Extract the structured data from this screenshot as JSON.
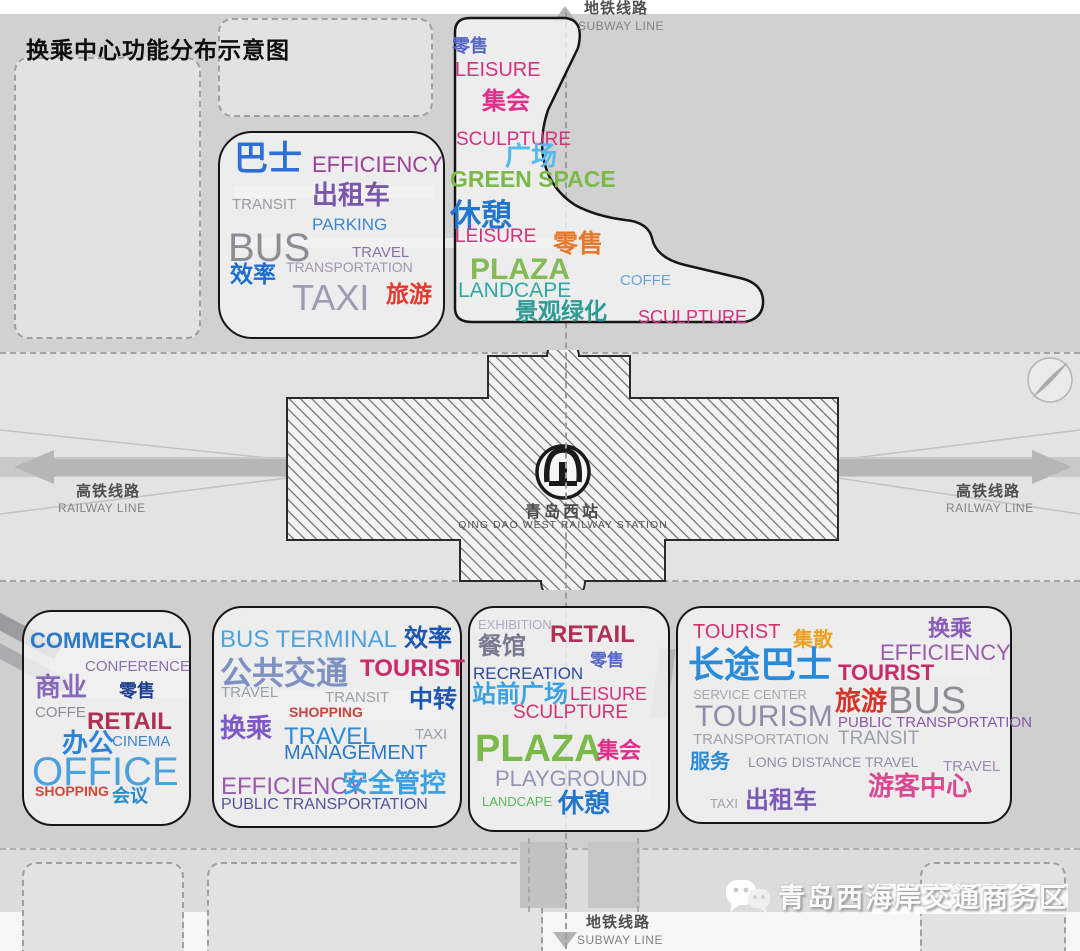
{
  "title": "换乘中心功能分布示意图",
  "axes": {
    "subway_top": {
      "cn": "地铁线路",
      "en": "SUBWAY LINE"
    },
    "subway_bottom": {
      "cn": "地铁线路",
      "en": "SUBWAY LINE"
    },
    "railway_left": {
      "cn": "高铁线路",
      "en": "RAILWAY LINE"
    },
    "railway_right": {
      "cn": "高铁线路",
      "en": "RAILWAY LINE"
    }
  },
  "station": {
    "cn": "青岛西站",
    "en": "QING DAO WEST RAILWAY STATION"
  },
  "watermark": "青岛西海岸交通商务区",
  "clouds": [
    {
      "id": "transit-hub-nw",
      "label": "bus / taxi transit zone",
      "words": [
        {
          "t": "巴士",
          "c": "#2e6fd6",
          "s": 34,
          "x": 14,
          "y": 9,
          "b": true
        },
        {
          "t": "EFFICIENCY",
          "c": "#9c3f98",
          "s": 22,
          "x": 92,
          "y": 21
        },
        {
          "t": "出租车",
          "c": "#7b57ab",
          "s": 26,
          "x": 92,
          "y": 49,
          "b": true
        },
        {
          "t": "TRANSIT",
          "c": "#9b9ba3",
          "s": 15,
          "x": 12,
          "y": 64
        },
        {
          "t": "PARKING",
          "c": "#3f86ce",
          "s": 17,
          "x": 92,
          "y": 83
        },
        {
          "t": "BUS",
          "c": "#8d8d97",
          "s": 40,
          "x": 8,
          "y": 95
        },
        {
          "t": "TRAVEL",
          "c": "#8f70ae",
          "s": 15,
          "x": 132,
          "y": 112
        },
        {
          "t": "TRANSPORTATION",
          "c": "#a095b2",
          "s": 14,
          "x": 66,
          "y": 127
        },
        {
          "t": "效率",
          "c": "#1e6ed2",
          "s": 23,
          "x": 10,
          "y": 130,
          "b": true
        },
        {
          "t": "TAXI",
          "c": "#a09ab3",
          "s": 36,
          "x": 72,
          "y": 147
        },
        {
          "t": "旅游",
          "c": "#e4392b",
          "s": 23,
          "x": 166,
          "y": 150,
          "b": true
        }
      ]
    },
    {
      "id": "plaza-ne",
      "label": "leisure / green space zone",
      "words": [
        {
          "t": "零售",
          "c": "#5667c8",
          "s": 18,
          "x": 9,
          "y": 25,
          "b": true
        },
        {
          "t": "LEISURE",
          "c": "#d62f80",
          "s": 20,
          "x": 12,
          "y": 48
        },
        {
          "t": "集会",
          "c": "#e02f8a",
          "s": 24,
          "x": 39,
          "y": 78,
          "b": true
        },
        {
          "t": "SCULPTURE",
          "c": "#d62f80",
          "s": 19,
          "x": 13,
          "y": 118
        },
        {
          "t": "广场",
          "c": "#54b9ec",
          "s": 26,
          "x": 62,
          "y": 131,
          "b": true
        },
        {
          "t": "GREEN SPACE",
          "c": "#7bb94a",
          "s": 23,
          "x": 7,
          "y": 156,
          "b": true
        },
        {
          "t": "休憩",
          "c": "#2277cd",
          "s": 31,
          "x": 7,
          "y": 188,
          "b": true
        },
        {
          "t": "LEISURE",
          "c": "#d62f80",
          "s": 19,
          "x": 12,
          "y": 215
        },
        {
          "t": "零售",
          "c": "#e87729",
          "s": 25,
          "x": 110,
          "y": 220,
          "b": true
        },
        {
          "t": "PLAZA",
          "c": "#84ba57",
          "s": 30,
          "x": 27,
          "y": 243,
          "b": true
        },
        {
          "t": "COFFE",
          "c": "#6ba1d9",
          "s": 15,
          "x": 177,
          "y": 261
        },
        {
          "t": "LANDCAPE",
          "c": "#2ea9a2",
          "s": 21,
          "x": 15,
          "y": 268
        },
        {
          "t": "景观绿化",
          "c": "#2e9a95",
          "s": 23,
          "x": 72,
          "y": 288,
          "b": true
        },
        {
          "t": "SCULPTURE",
          "c": "#d62f80",
          "s": 18,
          "x": 195,
          "y": 296
        }
      ]
    },
    {
      "id": "commercial-sw",
      "label": "commercial / office zone",
      "words": [
        {
          "t": "COMMERCIAL",
          "c": "#2b79c9",
          "s": 22,
          "x": 6,
          "y": 18,
          "b": true
        },
        {
          "t": "CONFERENCE",
          "c": "#8a70ae",
          "s": 15,
          "x": 61,
          "y": 47
        },
        {
          "t": "商业",
          "c": "#8a68b9",
          "s": 26,
          "x": 11,
          "y": 62,
          "b": true
        },
        {
          "t": "零售",
          "c": "#1c3f91",
          "s": 18,
          "x": 95,
          "y": 70,
          "b": true
        },
        {
          "t": "COFFE",
          "c": "#8d8d97",
          "s": 15,
          "x": 11,
          "y": 93
        },
        {
          "t": "RETAIL",
          "c": "#b13053",
          "s": 24,
          "x": 63,
          "y": 98,
          "b": true
        },
        {
          "t": "办公",
          "c": "#2b83d9",
          "s": 26,
          "x": 38,
          "y": 118,
          "b": true
        },
        {
          "t": "CINEMA",
          "c": "#3f86ce",
          "s": 15,
          "x": 88,
          "y": 122
        },
        {
          "t": "OFFICE",
          "c": "#4ba1dd",
          "s": 40,
          "x": 8,
          "y": 140
        },
        {
          "t": "SHOPPING",
          "c": "#d84639",
          "s": 14,
          "x": 11,
          "y": 172,
          "b": true
        },
        {
          "t": "会议",
          "c": "#2a8bc9",
          "s": 18,
          "x": 88,
          "y": 175,
          "b": true
        }
      ]
    },
    {
      "id": "bus-terminal-s",
      "label": "public transportation zone",
      "words": [
        {
          "t": "BUS TERMINAL",
          "c": "#4da4dd",
          "s": 24,
          "x": 6,
          "y": 20
        },
        {
          "t": "效率",
          "c": "#1c56b3",
          "s": 24,
          "x": 190,
          "y": 19,
          "b": true
        },
        {
          "t": "公共交通",
          "c": "#7e91c3",
          "s": 32,
          "x": 6,
          "y": 49,
          "b": true
        },
        {
          "t": "TOURIST",
          "c": "#c92b6b",
          "s": 24,
          "x": 146,
          "y": 49,
          "b": true
        },
        {
          "t": "TRAVEL",
          "c": "#9aa0a8",
          "s": 15,
          "x": 7,
          "y": 77
        },
        {
          "t": "TRANSIT",
          "c": "#9aa0a8",
          "s": 15,
          "x": 111,
          "y": 82
        },
        {
          "t": "中转",
          "c": "#1c56b3",
          "s": 24,
          "x": 195,
          "y": 80,
          "b": true
        },
        {
          "t": "SHOPPING",
          "c": "#c9433d",
          "s": 14,
          "x": 75,
          "y": 97,
          "b": true
        },
        {
          "t": "换乘",
          "c": "#7e58c9",
          "s": 26,
          "x": 6,
          "y": 107,
          "b": true
        },
        {
          "t": "TRAVEL",
          "c": "#2a8bd9",
          "s": 24,
          "x": 70,
          "y": 117
        },
        {
          "t": "TAXI",
          "c": "#9aa0a8",
          "s": 15,
          "x": 201,
          "y": 119
        },
        {
          "t": "MANAGEMENT",
          "c": "#2879c9",
          "s": 20,
          "x": 70,
          "y": 135
        },
        {
          "t": "EFFICIENCY",
          "c": "#9b5bab",
          "s": 24,
          "x": 7,
          "y": 167
        },
        {
          "t": "安全管控",
          "c": "#3aa1e3",
          "s": 26,
          "x": 128,
          "y": 162,
          "b": true
        },
        {
          "t": "PUBLIC TRANSPORTATION",
          "c": "#55549b",
          "s": 16,
          "x": 7,
          "y": 189
        }
      ]
    },
    {
      "id": "station-plaza-s",
      "label": "station front plaza zone",
      "words": [
        {
          "t": "EXHIBITION",
          "c": "#abacc3",
          "s": 13,
          "x": 8,
          "y": 10
        },
        {
          "t": "RETAIL",
          "c": "#b13053",
          "s": 24,
          "x": 80,
          "y": 15,
          "b": true
        },
        {
          "t": "餐馆",
          "c": "#797991",
          "s": 24,
          "x": 8,
          "y": 27,
          "b": true
        },
        {
          "t": "零售",
          "c": "#5667c8",
          "s": 17,
          "x": 120,
          "y": 44,
          "b": true
        },
        {
          "t": "RECREATION",
          "c": "#2c4b9d",
          "s": 17,
          "x": 3,
          "y": 57
        },
        {
          "t": "站前广场",
          "c": "#3aa1e3",
          "s": 24,
          "x": 2,
          "y": 75,
          "b": true
        },
        {
          "t": "LEISURE",
          "c": "#d62f80",
          "s": 18,
          "x": 100,
          "y": 77
        },
        {
          "t": "SCULPTURE",
          "c": "#d63071",
          "s": 19,
          "x": 43,
          "y": 95
        },
        {
          "t": "PLAZA",
          "c": "#7cb94b",
          "s": 38,
          "x": 5,
          "y": 122,
          "b": true
        },
        {
          "t": "集会",
          "c": "#e02f8a",
          "s": 22,
          "x": 127,
          "y": 132,
          "b": true
        },
        {
          "t": "PLAYGROUND",
          "c": "#9495b5",
          "s": 22,
          "x": 25,
          "y": 160
        },
        {
          "t": "LANDCAPE",
          "c": "#58b95b",
          "s": 13,
          "x": 12,
          "y": 187
        },
        {
          "t": "休憩",
          "c": "#2277cd",
          "s": 26,
          "x": 88,
          "y": 182,
          "b": true
        }
      ]
    },
    {
      "id": "tourist-se",
      "label": "tourist / long distance zone",
      "words": [
        {
          "t": "TOURIST",
          "c": "#d63071",
          "s": 20,
          "x": 15,
          "y": 14
        },
        {
          "t": "集散",
          "c": "#eea11e",
          "s": 20,
          "x": 115,
          "y": 22,
          "b": true
        },
        {
          "t": "换乘",
          "c": "#8a5bb9",
          "s": 22,
          "x": 250,
          "y": 10,
          "b": true
        },
        {
          "t": "长途巴士",
          "c": "#2a8bd9",
          "s": 36,
          "x": 10,
          "y": 39,
          "b": true
        },
        {
          "t": "EFFICIENCY",
          "c": "#9b5bab",
          "s": 22,
          "x": 202,
          "y": 34
        },
        {
          "t": "TOURIST",
          "c": "#c92b6b",
          "s": 22,
          "x": 160,
          "y": 54,
          "b": true
        },
        {
          "t": "SERVICE CENTER",
          "c": "#a6a6ae",
          "s": 13,
          "x": 15,
          "y": 80
        },
        {
          "t": "旅游",
          "c": "#da3129",
          "s": 26,
          "x": 157,
          "y": 80,
          "b": true
        },
        {
          "t": "BUS",
          "c": "#8d8d97",
          "s": 38,
          "x": 210,
          "y": 74
        },
        {
          "t": "TOURISM",
          "c": "#8e8ea9",
          "s": 30,
          "x": 17,
          "y": 94
        },
        {
          "t": "PUBLIC TRANSPORTATION",
          "c": "#8a59a9",
          "s": 15,
          "x": 160,
          "y": 107
        },
        {
          "t": "TRANSPORTATION",
          "c": "#a1a1a9",
          "s": 15,
          "x": 15,
          "y": 124
        },
        {
          "t": "TRANSIT",
          "c": "#9aa0a8",
          "s": 19,
          "x": 160,
          "y": 121
        },
        {
          "t": "服务",
          "c": "#2a8bd9",
          "s": 20,
          "x": 12,
          "y": 144,
          "b": true
        },
        {
          "t": "LONG DISTANCE TRAVEL",
          "c": "#8e8ea9",
          "s": 14,
          "x": 70,
          "y": 147
        },
        {
          "t": "TRAVEL",
          "c": "#9b8bb1",
          "s": 15,
          "x": 265,
          "y": 151
        },
        {
          "t": "游客中心",
          "c": "#d94891",
          "s": 26,
          "x": 190,
          "y": 165,
          "b": true
        },
        {
          "t": "TAXI",
          "c": "#a1a1a9",
          "s": 13,
          "x": 32,
          "y": 189
        },
        {
          "t": "出租车",
          "c": "#7c59b9",
          "s": 24,
          "x": 67,
          "y": 181,
          "b": true
        }
      ]
    }
  ]
}
